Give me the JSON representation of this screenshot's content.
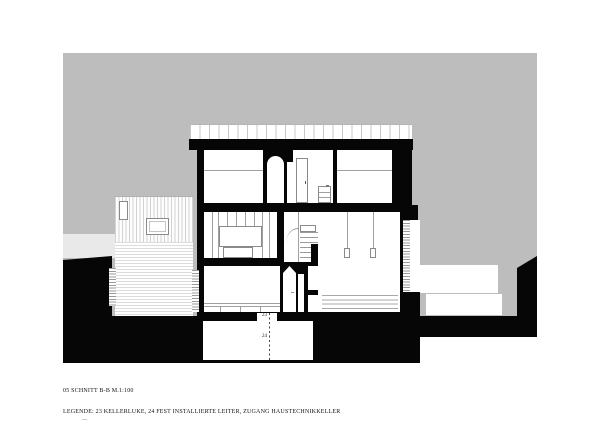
{
  "sheet": {
    "title": "05 SCHNITT B-B M.1:100",
    "legend": "LEGENDE: 23 KELLERLUKE, 24 FEST INSTALLIERTE LEITER, ZUGANG HAUSTECHNIKKELLER"
  },
  "drawing": {
    "annotations": {
      "hatch_label": "23",
      "ladder_label": "24"
    },
    "colors": {
      "sky": "#bdbdbd",
      "backdrop": "#e9e9e9",
      "ink": "#060606"
    }
  }
}
